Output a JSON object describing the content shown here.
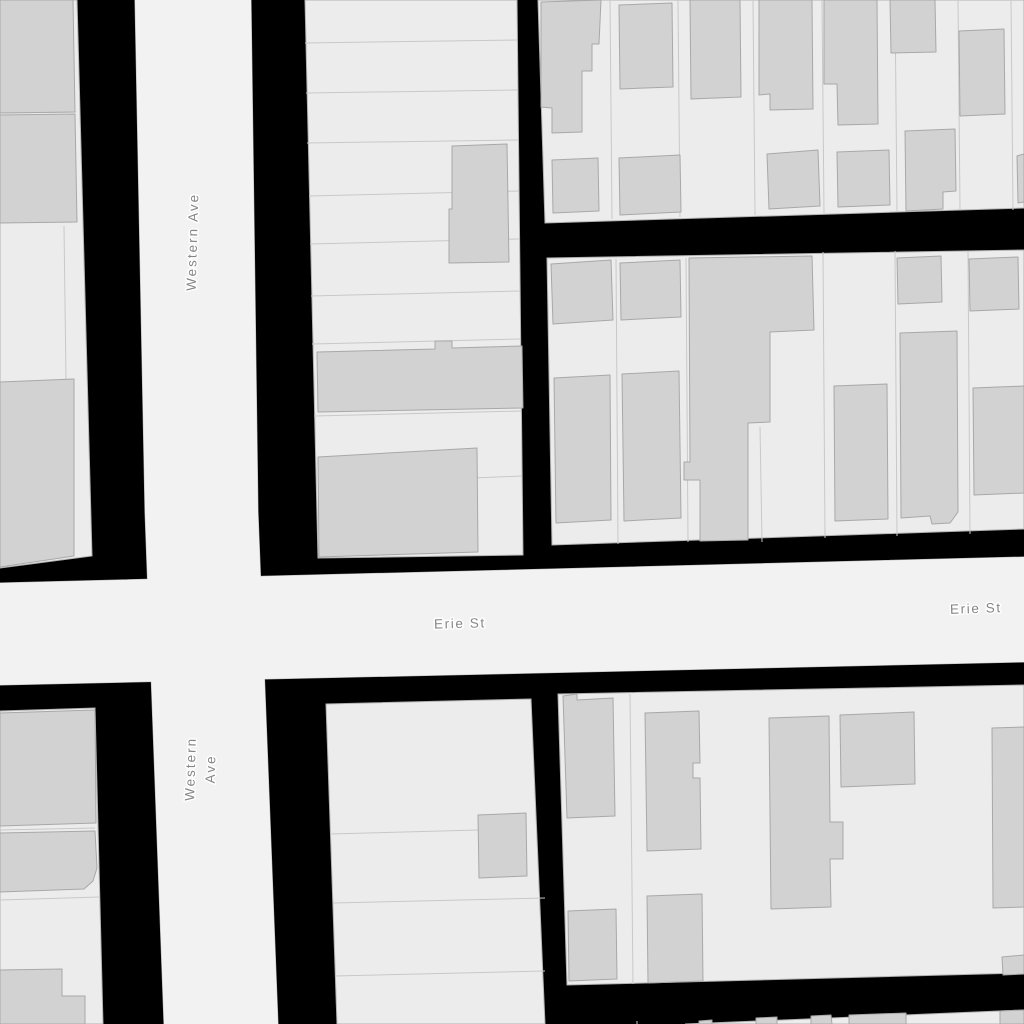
{
  "map": {
    "colors": {
      "background": "#000000",
      "street_fill": "#f2f2f2",
      "parcel_fill": "#ececec",
      "block_stroke": "#b2b2b2",
      "parcel_line": "#c8c8c8",
      "building_fill": "#d2d2d2",
      "building_stroke": "#a8a8a8",
      "label_color": "#868686",
      "label_halo": "#ffffff"
    },
    "streets": [
      {
        "id": "western-ave",
        "name": "Western Ave",
        "points": "135,0 251,0 258,512 278,1024 164,1024 145,512"
      },
      {
        "id": "erie-st",
        "name": "Erie St",
        "points": "0,583 1024,557 1024,662 0,685"
      }
    ],
    "labels": [
      {
        "id": "western-ave-top",
        "street": "Western Ave",
        "lines": [
          "Western Ave"
        ],
        "x": 197,
        "y": 242,
        "rotation": -88.4,
        "spacing": 2.0
      },
      {
        "id": "western-ave-bottom",
        "street": "Western Ave",
        "lines": [
          "Western",
          "Ave"
        ],
        "x": 205,
        "y": 769,
        "rotation": -88.4,
        "spacing": 2.0,
        "line_gap": 20
      },
      {
        "id": "erie-st-west",
        "street": "Erie St",
        "lines": [
          "Erie St"
        ],
        "x": 460,
        "y": 628,
        "rotation": -1.3,
        "spacing": 1.6
      },
      {
        "id": "erie-st-east",
        "street": "Erie St",
        "lines": [
          "Erie St"
        ],
        "x": 976,
        "y": 613,
        "rotation": -2.0,
        "spacing": 1.6
      }
    ],
    "blocks": [
      {
        "id": "block-nw-column",
        "points": "0,0 77,0 92,556 0,568"
      },
      {
        "id": "block-n-middle",
        "points": "305,0 517,0 523,555 318,558"
      },
      {
        "id": "block-ne-upper",
        "points": "538,0 1024,0 1024,208 545,223"
      },
      {
        "id": "block-ne-lower",
        "points": "547,258 1024,250 1024,529 552,545"
      },
      {
        "id": "block-sw-column",
        "points": "0,711 95,708 103,1024 0,1024"
      },
      {
        "id": "block-s-middle",
        "points": "326,704 531,699 545,1024 337,1024"
      },
      {
        "id": "block-se-main",
        "points": "558,694 1024,685 1024,973 567,985"
      },
      {
        "id": "block-s-bottom-strip",
        "points": "685,1024 1024,1010 1024,1024"
      }
    ],
    "parcel_lines": [
      [
        0,
        113,
        76,
        112
      ],
      [
        64,
        226,
        66,
        380
      ],
      [
        305,
        43,
        517,
        40
      ],
      [
        306,
        93,
        518,
        90
      ],
      [
        307,
        143,
        518,
        140
      ],
      [
        309,
        196,
        519,
        191
      ],
      [
        310,
        244,
        519,
        239
      ],
      [
        311,
        296,
        520,
        291
      ],
      [
        312,
        344,
        520,
        339
      ],
      [
        314,
        416,
        521,
        411
      ],
      [
        473,
        478,
        522,
        476
      ],
      [
        475,
        450,
        476,
        552
      ],
      [
        610,
        0,
        612,
        219
      ],
      [
        678,
        0,
        680,
        217
      ],
      [
        753,
        0,
        755,
        215
      ],
      [
        822,
        0,
        824,
        213
      ],
      [
        895,
        0,
        897,
        211
      ],
      [
        958,
        0,
        960,
        209
      ],
      [
        1011,
        0,
        1013,
        210
      ],
      [
        616,
        259,
        618,
        544
      ],
      [
        686,
        258,
        688,
        542
      ],
      [
        760,
        427,
        762,
        542
      ],
      [
        823,
        252,
        825,
        538
      ],
      [
        895,
        251,
        897,
        536
      ],
      [
        968,
        251,
        970,
        534
      ],
      [
        0,
        830,
        95,
        828
      ],
      [
        0,
        900,
        99,
        897
      ],
      [
        330,
        834,
        478,
        830
      ],
      [
        333,
        903,
        545,
        898
      ],
      [
        335,
        976,
        545,
        971
      ],
      [
        630,
        694,
        633,
        984
      ],
      [
        637,
        1024,
        637,
        1021
      ]
    ],
    "buildings": [
      {
        "points": "0,0 73,0 75,112 0,113"
      },
      {
        "points": "0,115 75,114 77,222 0,223"
      },
      {
        "points": "0,382 74,379 74,556 0,567"
      },
      {
        "points": "452,146 507,144 509,262 449,263 449,209 452,209"
      },
      {
        "points": "317,352 435,349 435,341 452,341 452,348 522,346 523,408 318,412"
      },
      {
        "points": "318,457 477,448 478,552 319,557"
      },
      {
        "points": "541,2 601,0 599,44 592,44 592,71 582,71 582,132 552,133 552,108 541,107"
      },
      {
        "points": "619,5 672,3 673,87 620,89"
      },
      {
        "points": "690,0 740,0 741,97 691,99"
      },
      {
        "points": "759,0 812,0 813,109 770,110 770,94 759,95"
      },
      {
        "points": "824,0 877,0 878,124 838,125 837,84 824,84"
      },
      {
        "points": "890,0 935,0 936,52 891,53"
      },
      {
        "points": "959,31 1004,29 1005,114 960,116"
      },
      {
        "points": "1017,156 1024,154 1024,202 1018,203"
      },
      {
        "points": "552,160 598,158 599,211 553,213"
      },
      {
        "points": "619,158 680,155 681,212 620,215"
      },
      {
        "points": "767,154 818,150 820,206 769,209"
      },
      {
        "points": "837,152 889,150 890,205 838,207"
      },
      {
        "points": "905,131 955,129 956,191 943,192 943,209 906,211"
      },
      {
        "points": "551,264 611,260 613,320 553,324"
      },
      {
        "points": "620,263 680,260 681,317 621,320"
      },
      {
        "points": "689,258 812,256 814,330 770,332 770,422 748,423 748,540 700,541 700,480 684,480 684,462 690,462"
      },
      {
        "points": "897,258 941,256 942,302 898,304"
      },
      {
        "points": "969,259 1018,257 1019,309 970,311"
      },
      {
        "points": "900,333 957,331 958,512 950,523 932,524 930,516 901,518"
      },
      {
        "points": "834,386 887,384 888,519 835,521"
      },
      {
        "points": "973,388 1024,386 1024,493 974,495"
      },
      {
        "points": "554,378 610,375 611,520 556,523"
      },
      {
        "points": "622,374 679,371 681,518 624,521"
      },
      {
        "points": "0,713 95,710 96,823 0,826"
      },
      {
        "points": "0,833 95,831 97,868 93,881 84,889 0,892"
      },
      {
        "points": "0,970 62,969 62,996 85,996 85,1024 0,1024"
      },
      {
        "points": "478,815 526,813 527,876 479,878"
      },
      {
        "points": "563,696 577,694 577,700 613,698 615,816 567,818"
      },
      {
        "points": "645,713 699,711 700,763 693,763 693,778 700,778 701,849 647,851"
      },
      {
        "points": "568,911 616,909 617,979 569,981"
      },
      {
        "points": "647,896 702,894 703,981 648,983"
      },
      {
        "points": "769,718 829,716 830,822 843,822 843,859 830,859 831,907 771,909"
      },
      {
        "points": "840,715 914,712 915,784 841,787"
      },
      {
        "points": "992,728 1024,727 1024,907 993,908"
      },
      {
        "points": "1002,957 1024,955 1024,974 1003,975"
      },
      {
        "points": "699,1021 712,1020 712,1024 699,1024"
      },
      {
        "points": "756,1018 777,1017 777,1024 756,1024"
      },
      {
        "points": "811,1016 831,1015 832,1024 811,1024"
      },
      {
        "points": "849,1015 906,1013 906,1024 849,1024"
      },
      {
        "points": "1000,1011 1024,1010 1024,1024 1000,1024"
      }
    ]
  }
}
